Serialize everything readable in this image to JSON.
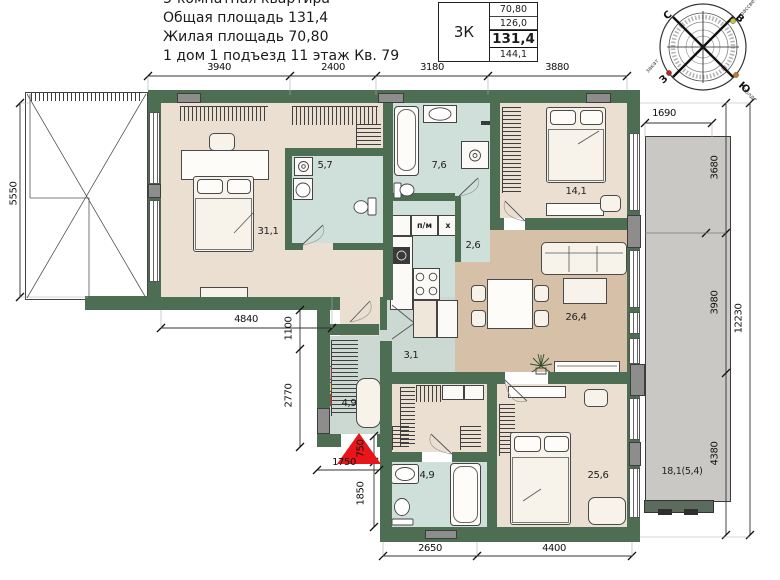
{
  "header": {
    "line1": "3-комнатная квартира",
    "line2": "Общая площадь 131,4",
    "line3": "Жилая площадь 70,80",
    "line4": "1 дом 1 подъезд 11 этаж Кв. 79"
  },
  "summary_table": {
    "type": "3К",
    "rows": [
      "70,80",
      "126,0",
      "131,4",
      "144,1"
    ]
  },
  "compass": {
    "north": "С",
    "east": "В",
    "west": "З",
    "south": "Ю",
    "sunrise": "рассвет",
    "sunset": "закат",
    "noon": "полдень"
  },
  "rooms": {
    "bedroom_master": "31,1",
    "bathroom_top": "5,7",
    "bathroom_mid": "7,6",
    "hall_small": "2,6",
    "bedroom_right": "14,1",
    "living_kitchen": "26,4",
    "corridor": "3,1",
    "entry_hall": "4,9",
    "bathroom_bottom": "4,9",
    "bedroom_bottom": "25,6",
    "balcony": "18,1(5,4)"
  },
  "kitchen": {
    "dishwasher": "п/м",
    "fridge": "х"
  },
  "dims": {
    "top": [
      "3940",
      "2400",
      "3180",
      "3880"
    ],
    "left": [
      "5550"
    ],
    "inner": [
      "4840",
      "1100",
      "2770",
      "1750",
      "750",
      "1850"
    ],
    "bottom": [
      "2650",
      "4400"
    ],
    "right": [
      "1690",
      "3680",
      "3980",
      "4380",
      "12230"
    ]
  },
  "colors": {
    "wall": "#4e6e53",
    "room_beige": "#eadfd1",
    "room_tan": "#d6c0a8",
    "room_wet": "#cfe0da",
    "room_hall": "#ccd8d2",
    "balcony_gray": "#c9c8c4",
    "entry_marker_red": "#e8151a"
  }
}
